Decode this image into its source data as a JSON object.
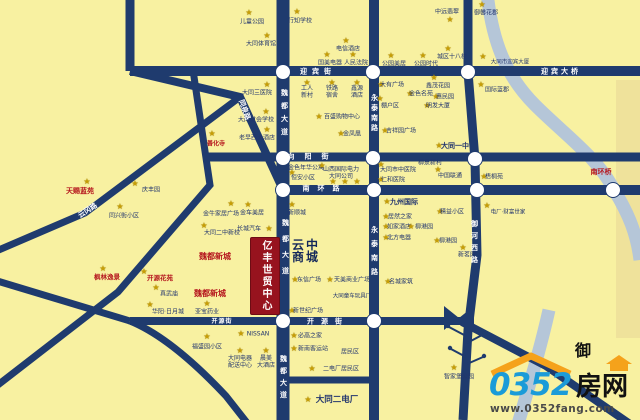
{
  "colors": {
    "bg": "#F8F1A1",
    "road": "#1F3B6E",
    "river": "#B5C6D8",
    "bank": "#EFE29B",
    "star": "#C79E05",
    "label": "#22356E",
    "redlabel": "#B5171E",
    "box": "#97131E",
    "logoblue": "#1B9BD8",
    "logoorange": "#F5A21B"
  },
  "map": {
    "landmark_box": {
      "text": "亿丰世贸中心"
    },
    "mall": {
      "text": "云中商城"
    },
    "river_char": "御",
    "streets": [
      {
        "t": "迎宾街",
        "x": 318,
        "y": 72,
        "ls": 5
      },
      {
        "t": "迎宾大桥",
        "x": 561,
        "y": 72,
        "ls": 3
      },
      {
        "t": "向阳街",
        "x": 313,
        "y": 157,
        "ls": 10
      },
      {
        "t": "南环路",
        "x": 325,
        "y": 189,
        "ls": 8
      },
      {
        "t": "开源街",
        "x": 222,
        "y": 322,
        "ls": 1,
        "s": 6
      },
      {
        "t": "开源街",
        "x": 328,
        "y": 322,
        "ls": 7
      },
      {
        "t": "魏都大道",
        "x": 284,
        "y": 115,
        "v": 1,
        "ls": 6
      },
      {
        "t": "魏都大道",
        "x": 285,
        "y": 251,
        "v": 1,
        "ls": 9
      },
      {
        "t": "魏都大道",
        "x": 283,
        "y": 379,
        "v": 1,
        "ls": 5
      },
      {
        "t": "永泰南路",
        "x": 374,
        "y": 114,
        "v": 1,
        "ls": 3
      },
      {
        "t": "永泰南路",
        "x": 374,
        "y": 254,
        "v": 1,
        "ls": 7
      },
      {
        "t": "御河西路",
        "x": 474,
        "y": 244,
        "v": 1,
        "ls": 5
      },
      {
        "t": "同泉路",
        "x": 244,
        "y": 110,
        "r": 70
      },
      {
        "t": "云冈路",
        "x": 88,
        "y": 211,
        "r": -33
      }
    ],
    "pois": [
      {
        "t": "儿童公园",
        "x": 252,
        "y": 22,
        "sx": 249,
        "sy": 13
      },
      {
        "t": "行知学校",
        "x": 300,
        "y": 21,
        "sx": 297,
        "sy": 12
      },
      {
        "t": "大同体育馆",
        "x": 261,
        "y": 44,
        "sx": 267,
        "sy": 36
      },
      {
        "t": "电信酒店",
        "x": 348,
        "y": 49,
        "sx": 346,
        "sy": 41
      },
      {
        "t": "国美电器",
        "x": 330,
        "y": 63,
        "sx": 327,
        "sy": 55
      },
      {
        "t": "人民法院",
        "x": 356,
        "y": 63,
        "sx": 353,
        "sy": 55
      },
      {
        "t": "公园美居",
        "x": 394,
        "y": 64,
        "sx": 391,
        "sy": 56
      },
      {
        "t": "公园时代",
        "x": 426,
        "y": 64,
        "sx": 423,
        "sy": 56
      },
      {
        "t": "城区十八校",
        "x": 452,
        "y": 57,
        "sx": 448,
        "sy": 49
      },
      {
        "t": "中远翡翠",
        "x": 447,
        "y": 12,
        "sx": 450,
        "sy": 20
      },
      {
        "t": "御馨花郡",
        "x": 486,
        "y": 13,
        "sx": 482,
        "sy": 5
      },
      {
        "t": "大同市迎宾大厦",
        "x": 510,
        "y": 63,
        "s": 5.5,
        "sx": 483,
        "sy": 57
      },
      {
        "t": "鑫茂花园",
        "x": 438,
        "y": 86,
        "sx": 434,
        "sy": 78
      },
      {
        "t": "国际蓝郡",
        "x": 497,
        "y": 90,
        "sx": 481,
        "sy": 85
      },
      {
        "t": "大同三医院",
        "x": 257,
        "y": 93,
        "sx": 267,
        "sy": 85
      },
      {
        "t": "大同财会学校",
        "x": 256,
        "y": 120,
        "sx": 266,
        "sy": 112
      },
      {
        "t": "老早西大酒店",
        "x": 257,
        "y": 138,
        "sx": 267,
        "sy": 130
      },
      {
        "t": "善化寺",
        "x": 216,
        "y": 144,
        "c": "r",
        "sx": 212,
        "sy": 134
      },
      {
        "t": "工人\n新村",
        "x": 307,
        "y": 92,
        "sx": 307,
        "sy": 83
      },
      {
        "t": "铁路\n宿舍",
        "x": 332,
        "y": 92,
        "sx": 332,
        "sy": 83
      },
      {
        "t": "鑫源\n酒店",
        "x": 357,
        "y": 92,
        "sx": 357,
        "sy": 83
      },
      {
        "t": "棚户区",
        "x": 390,
        "y": 106,
        "sx": 380,
        "sy": 99
      },
      {
        "t": "百盛购物中心",
        "x": 342,
        "y": 117,
        "sx": 319,
        "sy": 117
      },
      {
        "t": "金凤凰",
        "x": 352,
        "y": 134,
        "sx": 341,
        "sy": 134
      },
      {
        "t": "大有广场",
        "x": 392,
        "y": 85,
        "sx": 381,
        "sy": 85
      },
      {
        "t": "金色名苑",
        "x": 421,
        "y": 94,
        "sx": 410,
        "sy": 94
      },
      {
        "t": "惠民园",
        "x": 445,
        "y": 97,
        "sx": 436,
        "sy": 97
      },
      {
        "t": "明发大厦",
        "x": 438,
        "y": 106,
        "sx": 427,
        "sy": 106
      },
      {
        "t": "吉祥园广场",
        "x": 401,
        "y": 131,
        "sx": 385,
        "sy": 131
      },
      {
        "t": "大同一中",
        "x": 455,
        "y": 146,
        "s": 7,
        "b": 1,
        "sx": 439,
        "sy": 146
      },
      {
        "t": "金色年华公寓",
        "x": 306,
        "y": 168
      },
      {
        "t": "恒安小区",
        "x": 303,
        "y": 178,
        "sx": 292,
        "sy": 173
      },
      {
        "t": "山西国际电力\n大同公司",
        "x": 341,
        "y": 173,
        "sx": 322,
        "sy": 166
      },
      {
        "t": "",
        "x": 333,
        "y": 182,
        "sx": 333,
        "sy": 182
      },
      {
        "t": "",
        "x": 345,
        "y": 182,
        "sx": 345,
        "sy": 182
      },
      {
        "t": "",
        "x": 357,
        "y": 182,
        "sx": 357,
        "sy": 182
      },
      {
        "t": "大同市中医院",
        "x": 398,
        "y": 170,
        "sx": 381,
        "sy": 165
      },
      {
        "t": "仁和医院",
        "x": 393,
        "y": 180,
        "sx": 381,
        "sy": 180
      },
      {
        "t": "柳泉新村",
        "x": 430,
        "y": 163
      },
      {
        "t": "中国联通",
        "x": 450,
        "y": 176,
        "sx": 438,
        "sy": 170
      },
      {
        "t": "梧桐苑",
        "x": 494,
        "y": 177,
        "sx": 484,
        "sy": 177
      },
      {
        "t": "南环桥",
        "x": 601,
        "y": 172,
        "c": "r",
        "s": 7,
        "b": 1
      },
      {
        "t": "天赐蓝苑",
        "x": 80,
        "y": 191,
        "c": "r",
        "s": 7,
        "b": 1,
        "sx": 87,
        "sy": 182
      },
      {
        "t": "庆丰园",
        "x": 151,
        "y": 190,
        "sx": 135,
        "sy": 184
      },
      {
        "t": "同兴街小区",
        "x": 124,
        "y": 216,
        "sx": 120,
        "sy": 207
      },
      {
        "t": "金牛家居广场",
        "x": 221,
        "y": 214,
        "sx": 231,
        "sy": 204
      },
      {
        "t": "大同二中新校",
        "x": 222,
        "y": 233,
        "sx": 204,
        "sy": 226
      },
      {
        "t": "魏都新城",
        "x": 215,
        "y": 257,
        "c": "r",
        "s": 8,
        "b": 1
      },
      {
        "t": "魏都新城",
        "x": 210,
        "y": 294,
        "c": "r",
        "s": 8,
        "b": 1
      },
      {
        "t": "金车美居",
        "x": 252,
        "y": 213,
        "sx": 248,
        "sy": 205
      },
      {
        "t": "新顺城",
        "x": 297,
        "y": 213,
        "sx": 292,
        "sy": 205
      },
      {
        "t": "长城汽车",
        "x": 249,
        "y": 229,
        "sx": 269,
        "sy": 229
      },
      {
        "t": "枫林逸景",
        "x": 107,
        "y": 278,
        "c": "r",
        "s": 6.5,
        "b": 1,
        "sx": 103,
        "sy": 269
      },
      {
        "t": "开源花苑",
        "x": 160,
        "y": 279,
        "c": "r",
        "s": 6.5,
        "b": 1,
        "sx": 144,
        "sy": 272
      },
      {
        "t": "真武庙",
        "x": 169,
        "y": 294,
        "sx": 156,
        "sy": 288
      },
      {
        "t": "华阳·日月城",
        "x": 168,
        "y": 312,
        "sx": 150,
        "sy": 305
      },
      {
        "t": "亚宝药业",
        "x": 207,
        "y": 312,
        "sx": 207,
        "sy": 304
      },
      {
        "t": "福盛园小区",
        "x": 207,
        "y": 347,
        "sx": 207,
        "sy": 337
      },
      {
        "t": "NISSAN",
        "x": 258,
        "y": 334,
        "sx": 241,
        "sy": 334
      },
      {
        "t": "大同电器\n配送中心",
        "x": 240,
        "y": 362,
        "sx": 240,
        "sy": 351
      },
      {
        "t": "晨美\n大酒店",
        "x": 266,
        "y": 362,
        "sx": 266,
        "sy": 351
      },
      {
        "t": "九州国际",
        "x": 404,
        "y": 202,
        "s": 7,
        "b": 1,
        "sx": 387,
        "sy": 202
      },
      {
        "t": "居然之家",
        "x": 400,
        "y": 217,
        "sx": 386,
        "sy": 217
      },
      {
        "t": "如家酒店",
        "x": 399,
        "y": 227,
        "sx": 386,
        "sy": 227
      },
      {
        "t": "柳港园",
        "x": 424,
        "y": 227,
        "sx": 411,
        "sy": 227
      },
      {
        "t": "北方电器",
        "x": 399,
        "y": 238,
        "sx": 386,
        "sy": 238
      },
      {
        "t": "精益小区",
        "x": 452,
        "y": 212,
        "sx": 440,
        "sy": 212
      },
      {
        "t": "柳港园",
        "x": 448,
        "y": 241,
        "sx": 437,
        "sy": 241
      },
      {
        "t": "新茗园",
        "x": 467,
        "y": 255,
        "sx": 463,
        "sy": 248
      },
      {
        "t": "电厂·财富世家",
        "x": 508,
        "y": 213,
        "s": 5.5,
        "sx": 487,
        "sy": 206
      },
      {
        "t": "东信广场",
        "x": 309,
        "y": 280,
        "sx": 295,
        "sy": 280
      },
      {
        "t": "天美商业广场",
        "x": 352,
        "y": 280,
        "sx": 330,
        "sy": 280
      },
      {
        "t": "大同童车玩具厂",
        "x": 352,
        "y": 297,
        "s": 5.5
      },
      {
        "t": "新世纪广场",
        "x": 308,
        "y": 311,
        "sx": 292,
        "sy": 311
      },
      {
        "t": "名城家筑",
        "x": 401,
        "y": 282,
        "sx": 388,
        "sy": 282
      },
      {
        "t": "必高之家",
        "x": 310,
        "y": 336,
        "sx": 294,
        "sy": 336
      },
      {
        "t": "新南客运站",
        "x": 313,
        "y": 349,
        "sx": 294,
        "sy": 349
      },
      {
        "t": "居民区",
        "x": 350,
        "y": 352
      },
      {
        "t": "二电厂居民区",
        "x": 341,
        "y": 369,
        "sx": 312,
        "sy": 369
      },
      {
        "t": "大同二电厂",
        "x": 337,
        "y": 400,
        "s": 8.5,
        "b": 1,
        "sx": 308,
        "sy": 400
      },
      {
        "t": "智家堡公园",
        "x": 459,
        "y": 377,
        "sx": 454,
        "sy": 368
      }
    ]
  },
  "logo": {
    "number": "0352",
    "suffix": "房网",
    "url": "www.0352fang.com"
  }
}
